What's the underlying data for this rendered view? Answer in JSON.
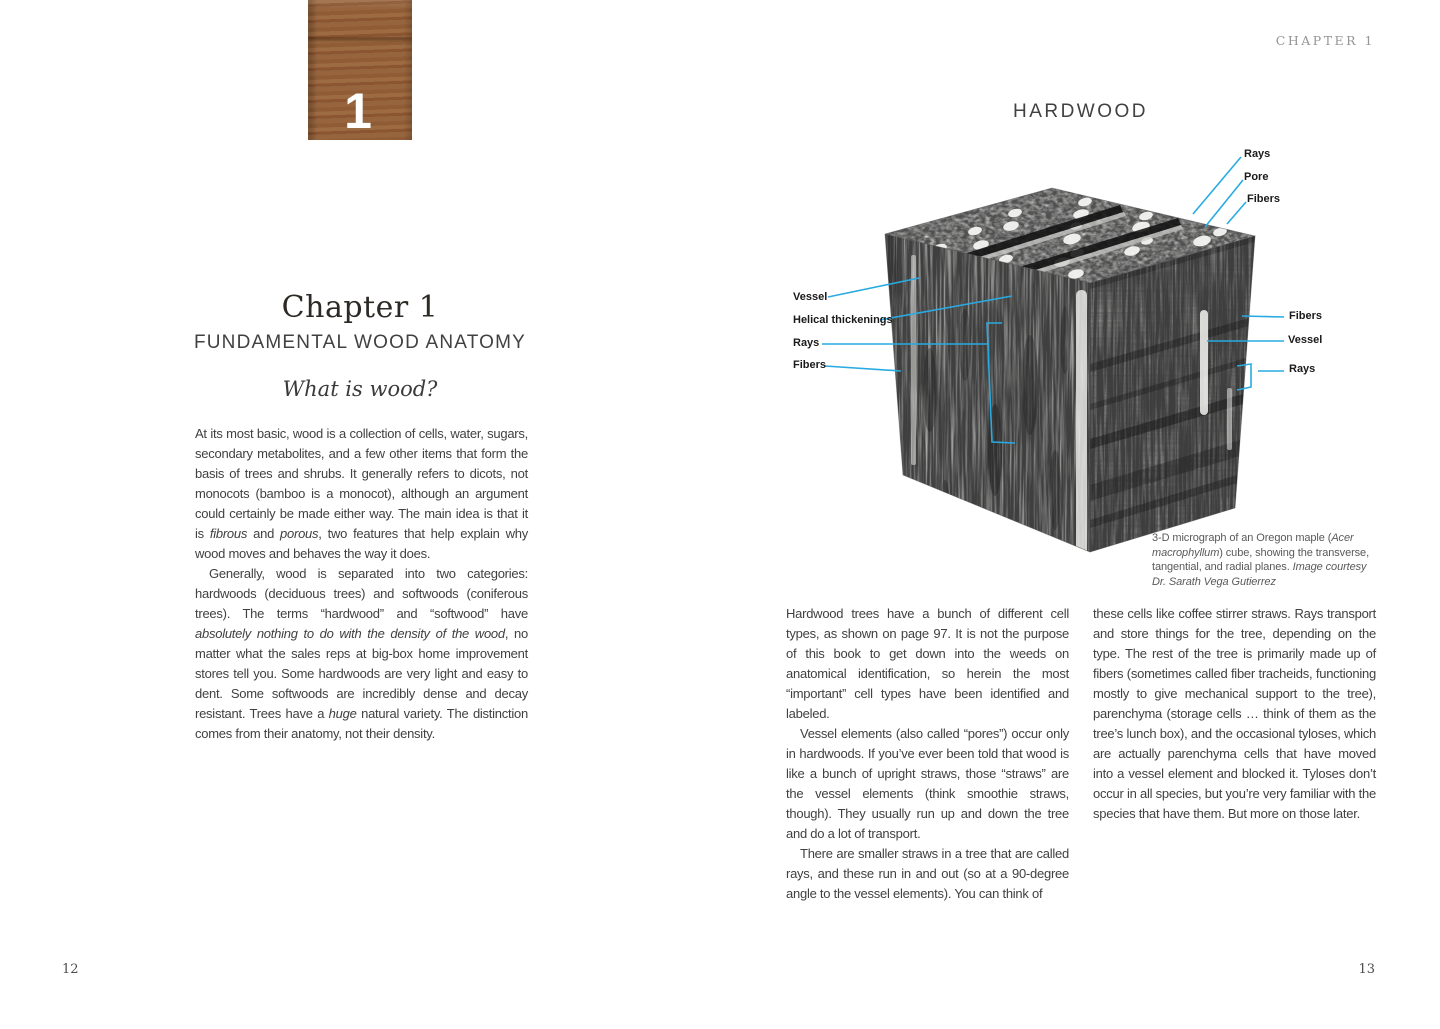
{
  "colors": {
    "accent": "#29abe2",
    "wood_light": "#9c6b42",
    "wood_dark": "#8a5530",
    "body_text": "#414042",
    "caption_text": "#58595b",
    "running_head_text": "#939598"
  },
  "left_page": {
    "tab_number": "1",
    "title": "Chapter 1",
    "subtitle": "FUNDAMENTAL WOOD ANATOMY",
    "question": "What is wood?",
    "body": [
      {
        "indent": false,
        "segments": [
          {
            "t": "At its most basic, wood is a collection of cells, water, sugars, secondary metabolites, and a few other items that form the basis of trees and shrubs. It generally refers to dicots, not monocots (bamboo is a monocot), although an argument could certainly be made either way. The main idea is that it is "
          },
          {
            "t": "fibrous",
            "i": true
          },
          {
            "t": " and "
          },
          {
            "t": "porous",
            "i": true
          },
          {
            "t": ", two features that help explain why wood moves and behaves the way it does."
          }
        ]
      },
      {
        "indent": true,
        "segments": [
          {
            "t": "Generally, wood is separated into two categories: hardwoods (deciduous trees) and softwoods (coniferous trees). The terms “hardwood” and “softwood” have "
          },
          {
            "t": "absolutely nothing to do with the density of the wood",
            "i": true
          },
          {
            "t": ", no matter what the sales reps at big-box home improvement stores tell you. Some hardwoods are very light and easy to dent. Some softwoods are incredibly dense and decay resistant. Trees have a "
          },
          {
            "t": "huge",
            "i": true
          },
          {
            "t": " natural variety. The distinction comes from their anatomy, not their density."
          }
        ]
      }
    ],
    "page_number": "12"
  },
  "right_page": {
    "running_head": "CHAPTER 1",
    "heading": "HARDWOOD",
    "figure": {
      "labels": {
        "rays_top": "Rays",
        "pore": "Pore",
        "fibers_top": "Fibers",
        "vessel_left": "Vessel",
        "helical": "Helical thickenings",
        "rays_left": "Rays",
        "fibers_left": "Fibers",
        "fibers_right": "Fibers",
        "vessel_right": "Vessel",
        "rays_right": "Rays"
      },
      "caption": [
        {
          "t": "3-D micrograph of an Oregon maple ("
        },
        {
          "t": "Acer macrophyllum",
          "i": true
        },
        {
          "t": ") cube, showing the transverse, tangential, and radial planes. "
        },
        {
          "t": "Image courtesy Dr. Sarath Vega Gutierrez",
          "i": true
        }
      ]
    },
    "column1": [
      {
        "indent": false,
        "segments": [
          {
            "t": "Hardwood trees have a bunch of different cell types, as shown on page 97. It is not the purpose of this book to get down into the weeds on anatomical identification, so herein the most “important” cell types have been identified and labeled."
          }
        ]
      },
      {
        "indent": true,
        "segments": [
          {
            "t": "Vessel elements (also called “pores”) occur only in hardwoods. If you’ve ever been told that wood is like a bunch of upright straws, those “straws” are the vessel elements (think smoothie straws, though). They usually run up and down the tree and do a lot of transport."
          }
        ]
      },
      {
        "indent": true,
        "segments": [
          {
            "t": "There are smaller straws in a tree that are called rays, and these run in and out (so at a 90-degree angle to the vessel elements). You can think of"
          }
        ]
      }
    ],
    "column2": [
      {
        "indent": false,
        "segments": [
          {
            "t": "these cells like coffee stirrer straws. Rays transport and store things for the tree, depending on the type. The rest of the tree is primarily made up of fibers (sometimes called fiber tracheids, functioning mostly to give mechanical support to the tree), parenchyma (storage cells … think of them as the tree’s lunch box), and the occasional tyloses, which are actually parenchyma cells that have moved into a vessel element and blocked it. Tyloses don’t occur in all species, but you’re very familiar with the species that have them. But more on those later."
          }
        ]
      }
    ],
    "page_number": "13"
  }
}
